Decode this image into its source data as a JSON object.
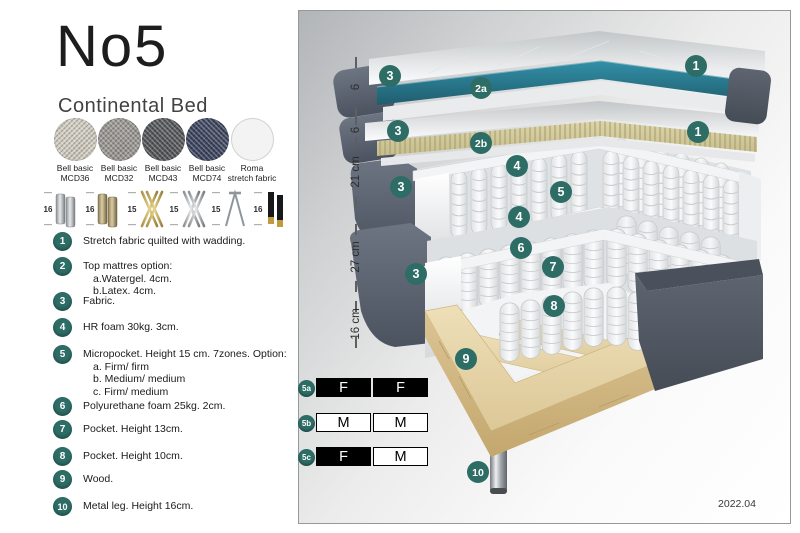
{
  "header": {
    "title": "No5",
    "subtitle": "Continental Bed"
  },
  "fabrics": [
    {
      "line1": "Bell basic",
      "line2": "MCD36",
      "color": "#d3cec2"
    },
    {
      "line1": "Bell basic",
      "line2": "MCD32",
      "color": "#9b9894"
    },
    {
      "line1": "Bell basic",
      "line2": "MCD43",
      "color": "#54575a"
    },
    {
      "line1": "Bell basic",
      "line2": "MCD74",
      "color": "#3d4560"
    },
    {
      "line1": "Roma",
      "line2": "stretch fabric",
      "color": "#f3f3f3"
    }
  ],
  "legs": [
    {
      "height": "16",
      "style": "cylinder-silver"
    },
    {
      "height": "16",
      "style": "cylinder-bronze"
    },
    {
      "height": "15",
      "style": "twisted-gold"
    },
    {
      "height": "15",
      "style": "twisted-silver"
    },
    {
      "height": "15",
      "style": "hairpin-metal"
    },
    {
      "height": "16",
      "style": "tapered-black-gold"
    }
  ],
  "features": [
    {
      "num": "1",
      "lines": [
        "Stretch fabric quilted with wadding."
      ]
    },
    {
      "num": "2",
      "lines": [
        "Top mattres option:",
        "a.Watergel. 4cm.",
        "b.Latex. 4cm."
      ]
    },
    {
      "num": "3",
      "lines": [
        "Fabric."
      ]
    },
    {
      "num": "4",
      "lines": [
        "HR foam 30kg. 3cm."
      ]
    },
    {
      "num": "5",
      "lines": [
        "Micropocket. Height 15 cm. 7zones. Option:",
        "a. Firm/ firm",
        "b. Medium/ medium",
        "c. Firm/ medium"
      ]
    },
    {
      "num": "6",
      "lines": [
        "Polyurethane foam 25kg. 2cm."
      ]
    },
    {
      "num": "7",
      "lines": [
        "Pocket. Height 13cm."
      ]
    },
    {
      "num": "8",
      "lines": [
        "Pocket. Height 10cm."
      ]
    },
    {
      "num": "9",
      "lines": [
        "Wood."
      ]
    },
    {
      "num": "10",
      "lines": [
        "Metal leg. Height 16cm."
      ]
    }
  ],
  "diagram": {
    "ruler": [
      {
        "label": "6"
      },
      {
        "label": "6"
      },
      {
        "label": "21 cm"
      },
      {
        "label": "27 cm"
      },
      {
        "label": "16 cm"
      }
    ],
    "callouts": {
      "c1a": "1",
      "c3a": "3",
      "c2a": "2a",
      "c3b": "3",
      "c1b": "1",
      "c2b": "2b",
      "c4a": "4",
      "c3c": "3",
      "c5": "5",
      "c4b": "4",
      "c6": "6",
      "c7": "7",
      "c3d": "3",
      "c8": "8",
      "c9": "9",
      "c10": "10"
    },
    "firmness": [
      {
        "id": "5a",
        "cells": [
          {
            "label": "F",
            "variant": "dark"
          },
          {
            "label": "F",
            "variant": "dark"
          }
        ]
      },
      {
        "id": "5b",
        "cells": [
          {
            "label": "M",
            "variant": "light"
          },
          {
            "label": "M",
            "variant": "light"
          }
        ]
      },
      {
        "id": "5c",
        "cells": [
          {
            "label": "F",
            "variant": "dark"
          },
          {
            "label": "M",
            "variant": "light"
          }
        ]
      }
    ],
    "version": "2022.04"
  },
  "colors": {
    "accent_teal": "#2e6d66",
    "mattress_teal": "#2b7f95",
    "latex_tan": "#d6cfa2",
    "fabric_slate": "#5a6170",
    "wood": "#e2d2a6"
  }
}
